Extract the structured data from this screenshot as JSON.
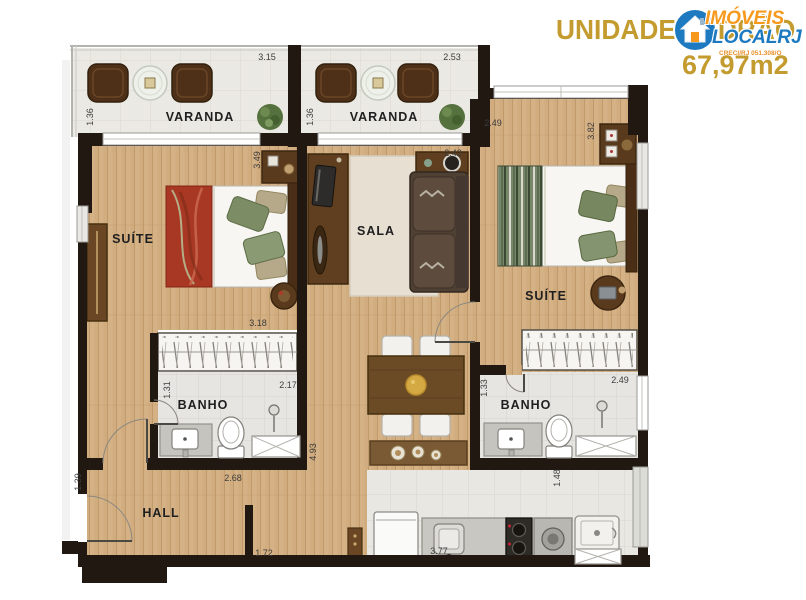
{
  "header": {
    "title": "UNIDADE PADRÃO",
    "area": "67,97m2"
  },
  "logo": {
    "line1": "IMÓVEIS",
    "line2": "LOCALRJ",
    "subtext": "CRECI/RJ 051.308/O"
  },
  "colors": {
    "title_gold": "#c49b2e",
    "logo_orange": "#f6991c",
    "logo_blue": "#1d7ac1",
    "wall": "#211812",
    "wood": "#d1ac7e"
  },
  "rooms": {
    "varanda_left": {
      "label": "VARANDA",
      "dim_w": "3.15",
      "dim_h": "1.36"
    },
    "varanda_mid": {
      "label": "VARANDA",
      "dim_w": "2.53",
      "dim_h": "1.36"
    },
    "suite_left": {
      "label": "SUÍTE",
      "dim_h": "3.49",
      "closet_w": "3.18"
    },
    "sala": {
      "label": "SALA",
      "dim_w": "2.42"
    },
    "suite_right": {
      "label": "SUÍTE",
      "dim_w": "2.49",
      "dim_h": "3.82"
    },
    "banho_left": {
      "label": "BANHO",
      "dim_h": "1.31",
      "dim_w": "2.17"
    },
    "banho_right": {
      "label": "BANHO",
      "dim_h": "1.33",
      "dim_w": "2.49"
    },
    "hall": {
      "label": "HALL",
      "dim_h": "1.39",
      "dim_w": "2.68",
      "door_w": "1.72"
    },
    "living": {
      "dim_h": "4.93"
    },
    "cozinha": {
      "dim_w": "3.77",
      "dim_h": "1.48"
    }
  }
}
